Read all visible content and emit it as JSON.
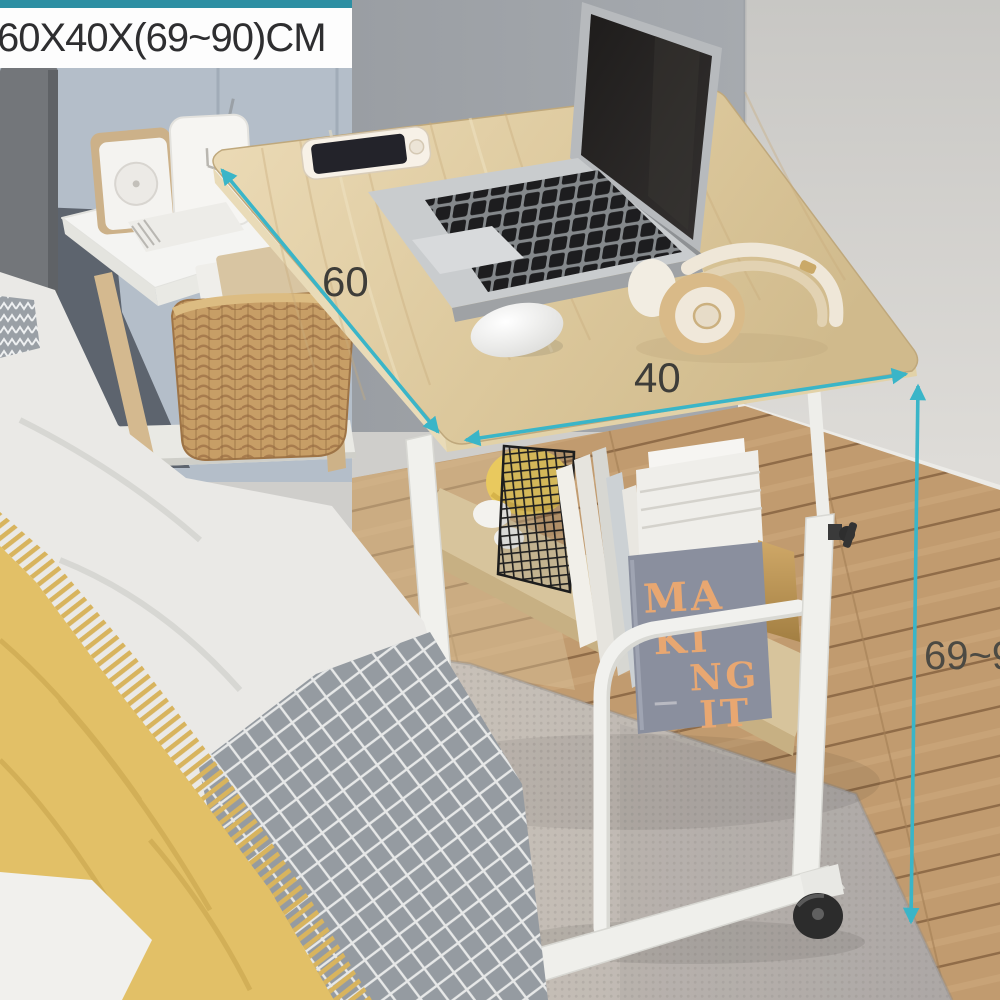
{
  "banner": {
    "text": "60X40X(69~90)CM",
    "strip_color": "#2d8fa3",
    "background": "#fdfdfd",
    "text_color": "#2e2e30"
  },
  "annotations": {
    "color": "#3ab5c8",
    "width_label": "60",
    "depth_label": "40",
    "height_label": "69~90"
  },
  "shelf_book": {
    "cover_color": "#8a8f9e",
    "title_color": "#e8a771",
    "title_lines": [
      "MA",
      "KI",
      "NG",
      "IT"
    ]
  },
  "objects": [
    "adjustable-overbed-laptop-desk",
    "laptop",
    "smartphone",
    "computer-mouse",
    "wireless-headphones",
    "book-shelf-with-books",
    "wire-basket",
    "caster-wheel",
    "height-adjust-knob",
    "bedside-table",
    "radio",
    "cube-clock",
    "wicker-basket",
    "bed-with-yellow-throw-blanket",
    "gray-lattice-blanket",
    "rug",
    "wood-floor"
  ],
  "palette": {
    "desk_wood": "#ddc99e",
    "frame_white": "#f1f1ed",
    "floor_wood": "#bf9a6d",
    "rug": "#c4bdb5",
    "blanket_yellow": "#e2c067",
    "lattice_blanket_gray": "#959ba1",
    "wall_left": "#b4bec9",
    "wall_mid": "#a0a4a9",
    "wall_right": "#d6d5d1"
  }
}
